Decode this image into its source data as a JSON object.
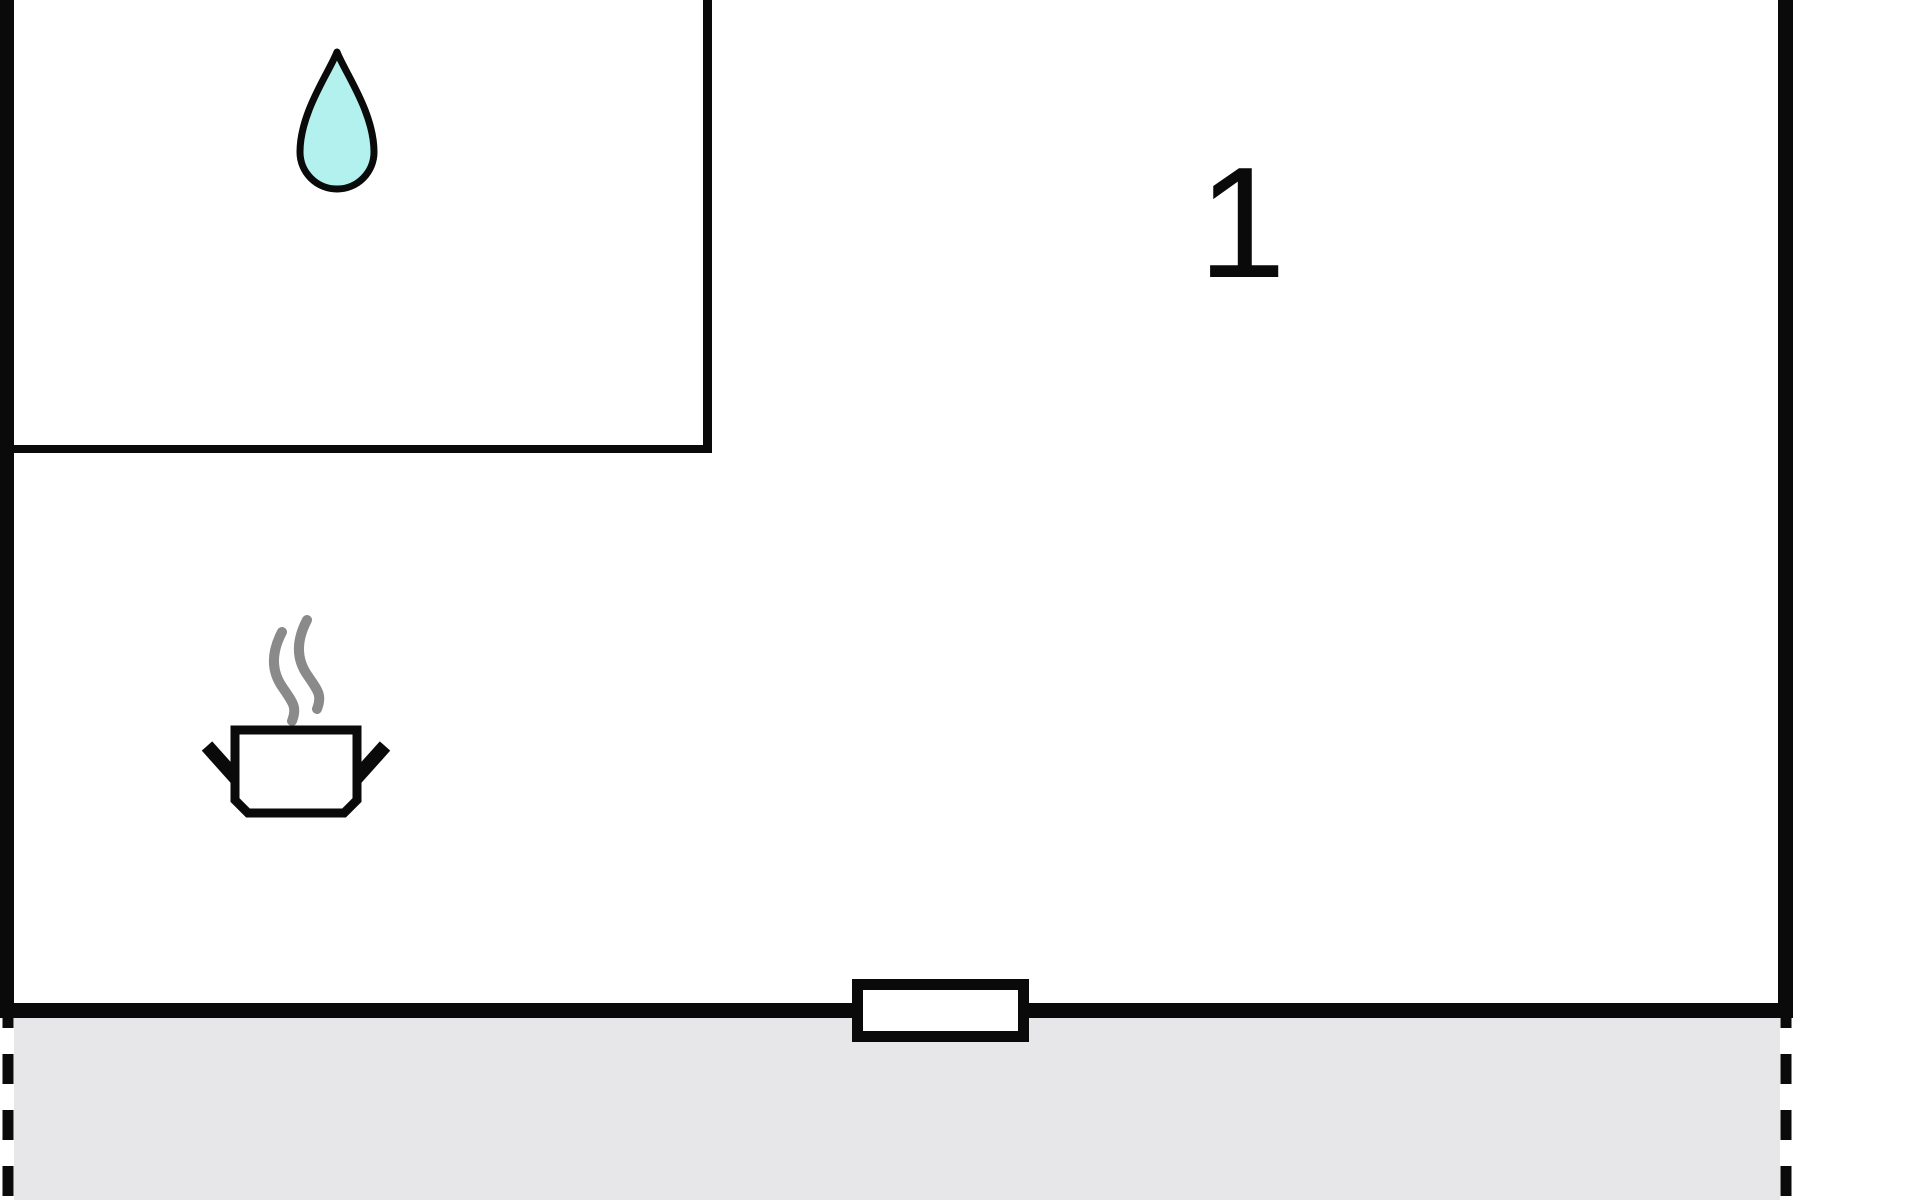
{
  "floorplan": {
    "room": {
      "label": "1"
    },
    "icons": {
      "water_drop": "water-drop",
      "steam_pot": "steaming-pot"
    },
    "colors": {
      "wall": "#0a0a0a",
      "background": "#ffffff",
      "terrace": "#e7e7ea",
      "water_drop_fill": "#b3f1ee",
      "steam": "#8a8a8a",
      "pot_fill": "#ffffff",
      "window_fill": "#ffffff"
    }
  }
}
